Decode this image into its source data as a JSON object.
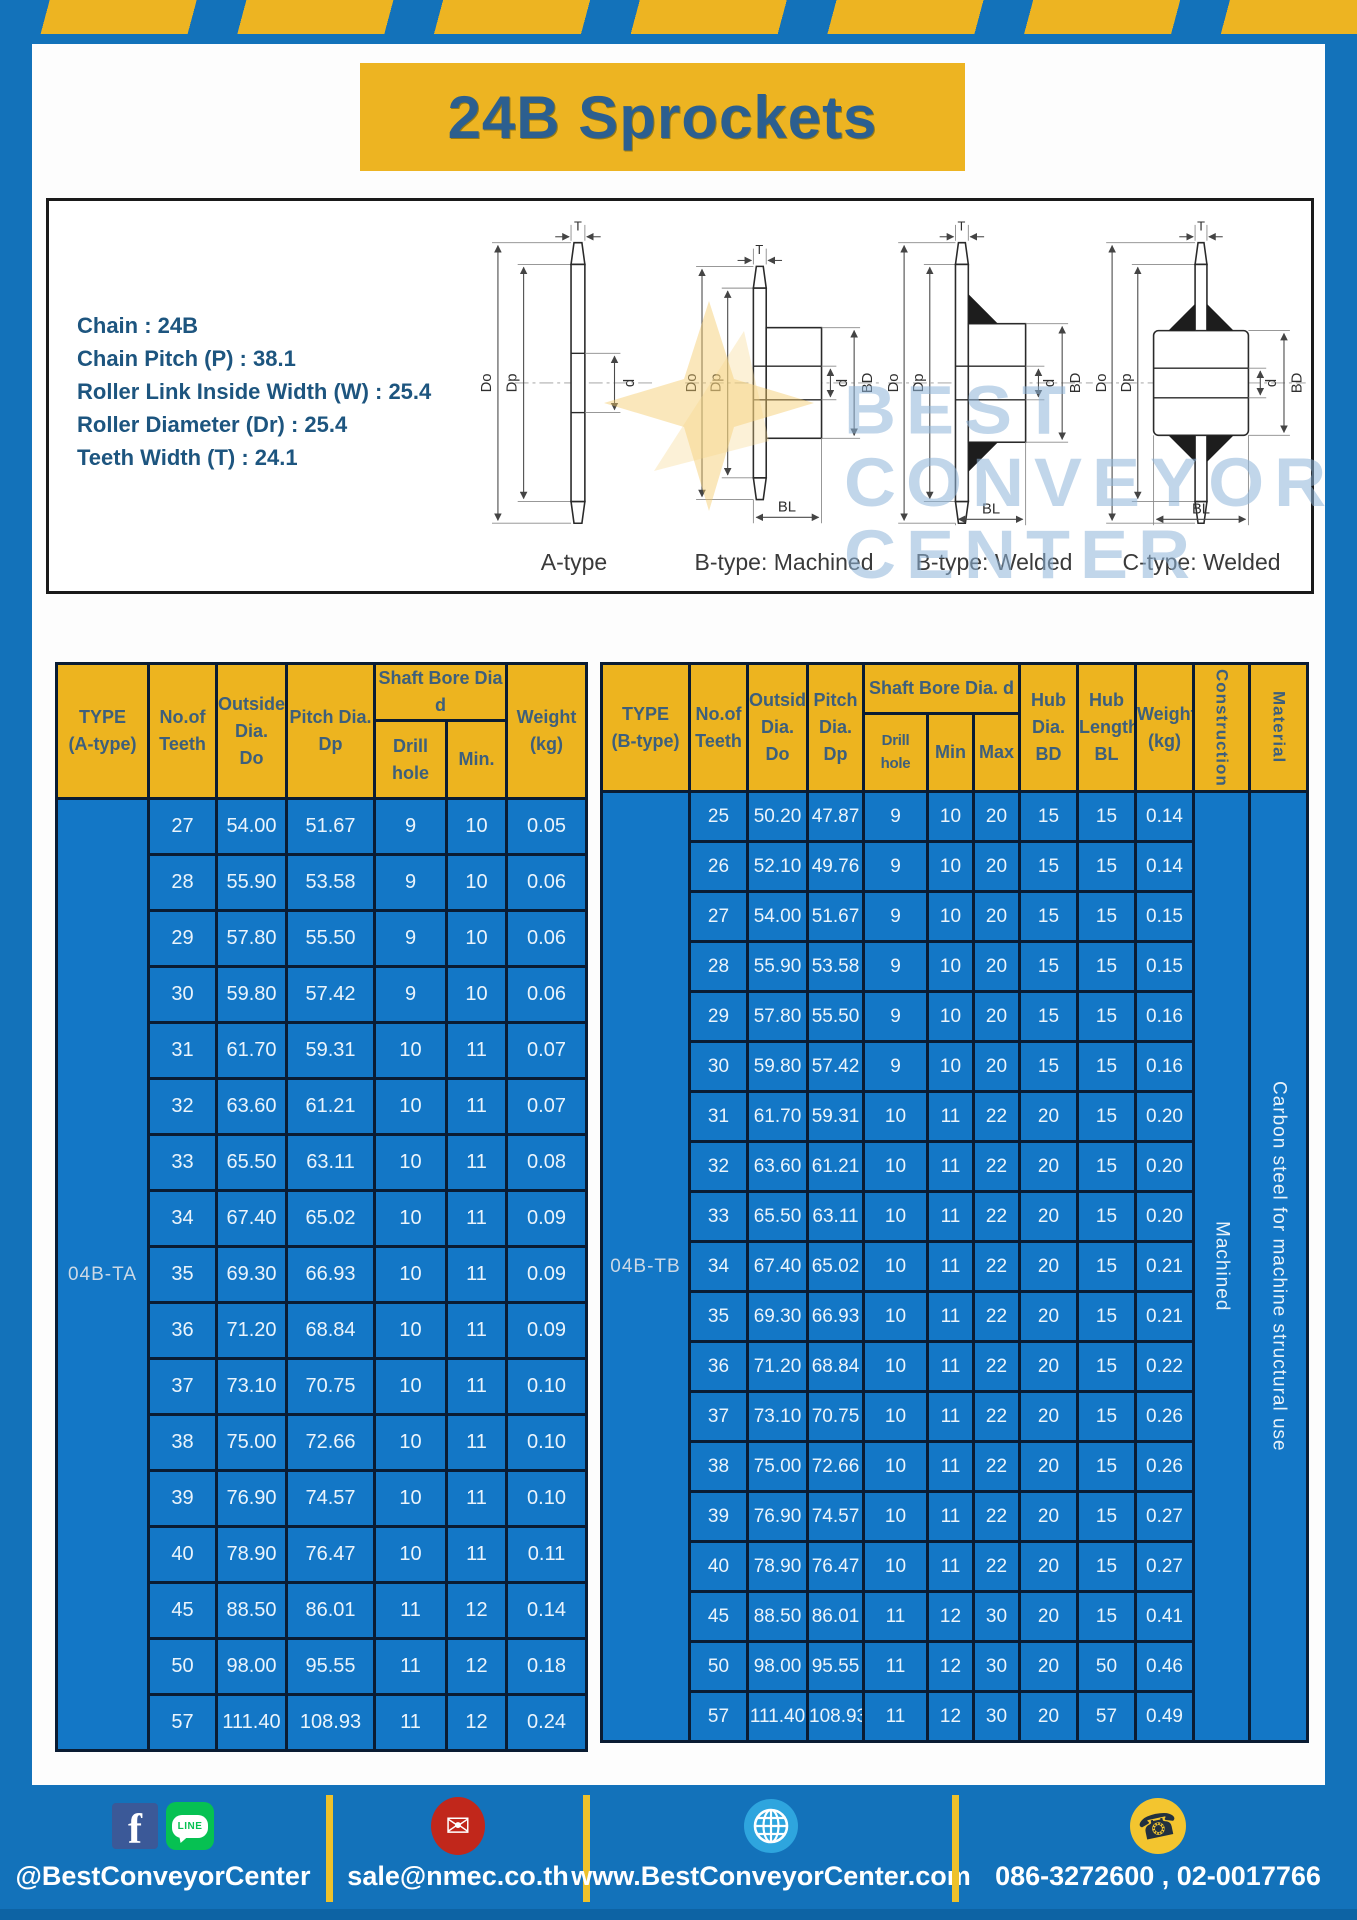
{
  "title": "24B Sprockets",
  "specs": [
    "Chain  : 24B",
    "Chain Pitch (P)  :  38.1",
    "Roller Link Inside Width (W)  :  25.4",
    "Roller Diameter (Dr)  : 25.4",
    "Teeth Width (T)  :  24.1"
  ],
  "diagrams": {
    "captions": [
      "A-type",
      "B-type: Machined",
      "B-type: Welded",
      "C-type: Welded"
    ],
    "dims": {
      "T": "T",
      "Do": "Do",
      "Dp": "Dp",
      "d": "d",
      "BD": "BD",
      "BL": "BL"
    }
  },
  "watermark": {
    "line1": "BEST",
    "line2": "CONVEYOR",
    "line3": "CENTER"
  },
  "table_a": {
    "headers": {
      "type": "TYPE\n(A-type)",
      "teeth": "No.of\nTeeth",
      "outside": "Outside\nDia.\nDo",
      "pitch": "Pitch Dia.\nDp",
      "shaft_bore": "Shaft Bore Dia d",
      "drill": "Drill hole",
      "min": "Min.",
      "weight": "Weight\n(kg)"
    },
    "type_label": "04B-TA",
    "rows": [
      [
        "27",
        "54.00",
        "51.67",
        "9",
        "10",
        "0.05"
      ],
      [
        "28",
        "55.90",
        "53.58",
        "9",
        "10",
        "0.06"
      ],
      [
        "29",
        "57.80",
        "55.50",
        "9",
        "10",
        "0.06"
      ],
      [
        "30",
        "59.80",
        "57.42",
        "9",
        "10",
        "0.06"
      ],
      [
        "31",
        "61.70",
        "59.31",
        "10",
        "11",
        "0.07"
      ],
      [
        "32",
        "63.60",
        "61.21",
        "10",
        "11",
        "0.07"
      ],
      [
        "33",
        "65.50",
        "63.11",
        "10",
        "11",
        "0.08"
      ],
      [
        "34",
        "67.40",
        "65.02",
        "10",
        "11",
        "0.09"
      ],
      [
        "35",
        "69.30",
        "66.93",
        "10",
        "11",
        "0.09"
      ],
      [
        "36",
        "71.20",
        "68.84",
        "10",
        "11",
        "0.09"
      ],
      [
        "37",
        "73.10",
        "70.75",
        "10",
        "11",
        "0.10"
      ],
      [
        "38",
        "75.00",
        "72.66",
        "10",
        "11",
        "0.10"
      ],
      [
        "39",
        "76.90",
        "74.57",
        "10",
        "11",
        "0.10"
      ],
      [
        "40",
        "78.90",
        "76.47",
        "10",
        "11",
        "0.11"
      ],
      [
        "45",
        "88.50",
        "86.01",
        "11",
        "12",
        "0.14"
      ],
      [
        "50",
        "98.00",
        "95.55",
        "11",
        "12",
        "0.18"
      ],
      [
        "57",
        "111.40",
        "108.93",
        "11",
        "12",
        "0.24"
      ]
    ]
  },
  "table_b": {
    "headers": {
      "type": "TYPE\n(B-type)",
      "teeth": "No.of\nTeeth",
      "outside": "Outside\nDia.\nDo",
      "pitch": "Pitch\nDia.\nDp",
      "shaft_bore": "Shaft Bore Dia.  d",
      "drill": "Drill hole",
      "min": "Min",
      "max": "Max",
      "hub_dia": "Hub\nDia.\nBD",
      "hub_len": "Hub\nLength\nBL",
      "weight": "Weight\n(kg)",
      "construction": "Construction",
      "material": "Material"
    },
    "type_label": "04B-TB",
    "construction": "Machined",
    "material": "Carbon steel for machine structural use",
    "rows": [
      [
        "25",
        "50.20",
        "47.87",
        "9",
        "10",
        "20",
        "15",
        "15",
        "0.14"
      ],
      [
        "26",
        "52.10",
        "49.76",
        "9",
        "10",
        "20",
        "15",
        "15",
        "0.14"
      ],
      [
        "27",
        "54.00",
        "51.67",
        "9",
        "10",
        "20",
        "15",
        "15",
        "0.15"
      ],
      [
        "28",
        "55.90",
        "53.58",
        "9",
        "10",
        "20",
        "15",
        "15",
        "0.15"
      ],
      [
        "29",
        "57.80",
        "55.50",
        "9",
        "10",
        "20",
        "15",
        "15",
        "0.16"
      ],
      [
        "30",
        "59.80",
        "57.42",
        "9",
        "10",
        "20",
        "15",
        "15",
        "0.16"
      ],
      [
        "31",
        "61.70",
        "59.31",
        "10",
        "11",
        "22",
        "20",
        "15",
        "0.20"
      ],
      [
        "32",
        "63.60",
        "61.21",
        "10",
        "11",
        "22",
        "20",
        "15",
        "0.20"
      ],
      [
        "33",
        "65.50",
        "63.11",
        "10",
        "11",
        "22",
        "20",
        "15",
        "0.20"
      ],
      [
        "34",
        "67.40",
        "65.02",
        "10",
        "11",
        "22",
        "20",
        "15",
        "0.21"
      ],
      [
        "35",
        "69.30",
        "66.93",
        "10",
        "11",
        "22",
        "20",
        "15",
        "0.21"
      ],
      [
        "36",
        "71.20",
        "68.84",
        "10",
        "11",
        "22",
        "20",
        "15",
        "0.22"
      ],
      [
        "37",
        "73.10",
        "70.75",
        "10",
        "11",
        "22",
        "20",
        "15",
        "0.26"
      ],
      [
        "38",
        "75.00",
        "72.66",
        "10",
        "11",
        "22",
        "20",
        "15",
        "0.26"
      ],
      [
        "39",
        "76.90",
        "74.57",
        "10",
        "11",
        "22",
        "20",
        "15",
        "0.27"
      ],
      [
        "40",
        "78.90",
        "76.47",
        "10",
        "11",
        "22",
        "20",
        "15",
        "0.27"
      ],
      [
        "45",
        "88.50",
        "86.01",
        "11",
        "12",
        "30",
        "20",
        "15",
        "0.41"
      ],
      [
        "50",
        "98.00",
        "95.55",
        "11",
        "12",
        "30",
        "20",
        "50",
        "0.46"
      ],
      [
        "57",
        "111.40",
        "108.93",
        "11",
        "12",
        "30",
        "20",
        "57",
        "0.49"
      ]
    ]
  },
  "footer": {
    "facebook_line": "@BestConveyorCenter",
    "line_text": "LINE",
    "email": "sale@nmec.co.th",
    "website": "www.BestConveyorCenter.com",
    "phone": "086-3272600 , 02-0017766"
  },
  "colors": {
    "frame_blue": "#1372BA",
    "cell_blue": "#1377C6",
    "accent_yellow": "#EDB41F",
    "table_border_navy": "#0A1C33",
    "title_text_blue": "#2C5F8F",
    "spec_text_blue": "#1D557F",
    "facebook_blue": "#3B5998",
    "line_green": "#06C152",
    "email_red": "#C1271B",
    "globe_blue": "#2EA5DE",
    "phone_yellow": "#F3C52F"
  }
}
